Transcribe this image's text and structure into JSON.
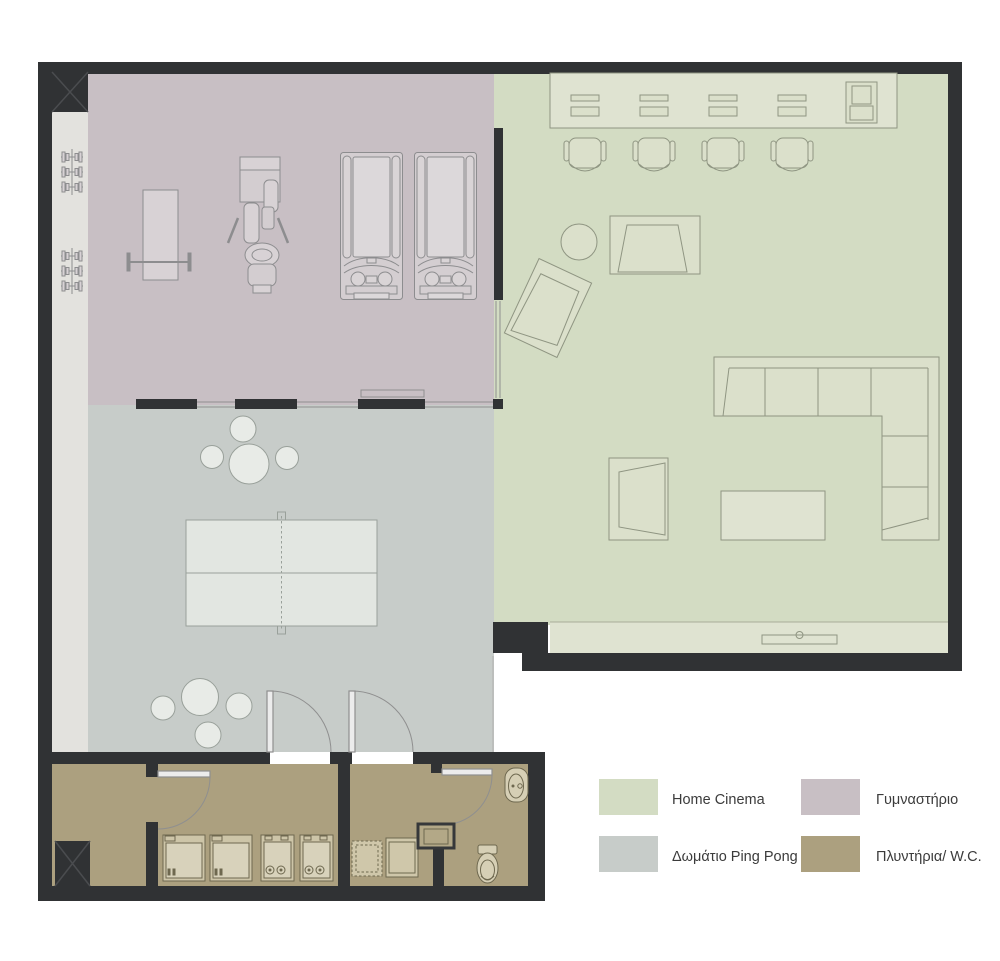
{
  "legend": {
    "items": [
      {
        "label": "Home Cinema",
        "color": "#d3dcc3"
      },
      {
        "label": "Γυμναστήριο",
        "color": "#c8bfc4"
      },
      {
        "label": "Δωμάτιο Ping Pong",
        "color": "#c7ccc9"
      },
      {
        "label": "Πλυντήρια/ W.C.",
        "color": "#aca07f"
      }
    ]
  },
  "colors": {
    "background": "#ffffff",
    "wall": "#303234",
    "column_cross": "#4a4c4f",
    "strip": "#e3e2de",
    "sill": "#dfe3d1",
    "desk": "#dfe3d1",
    "door_leaf": "#ececec",
    "text": "#3b3b3b"
  }
}
